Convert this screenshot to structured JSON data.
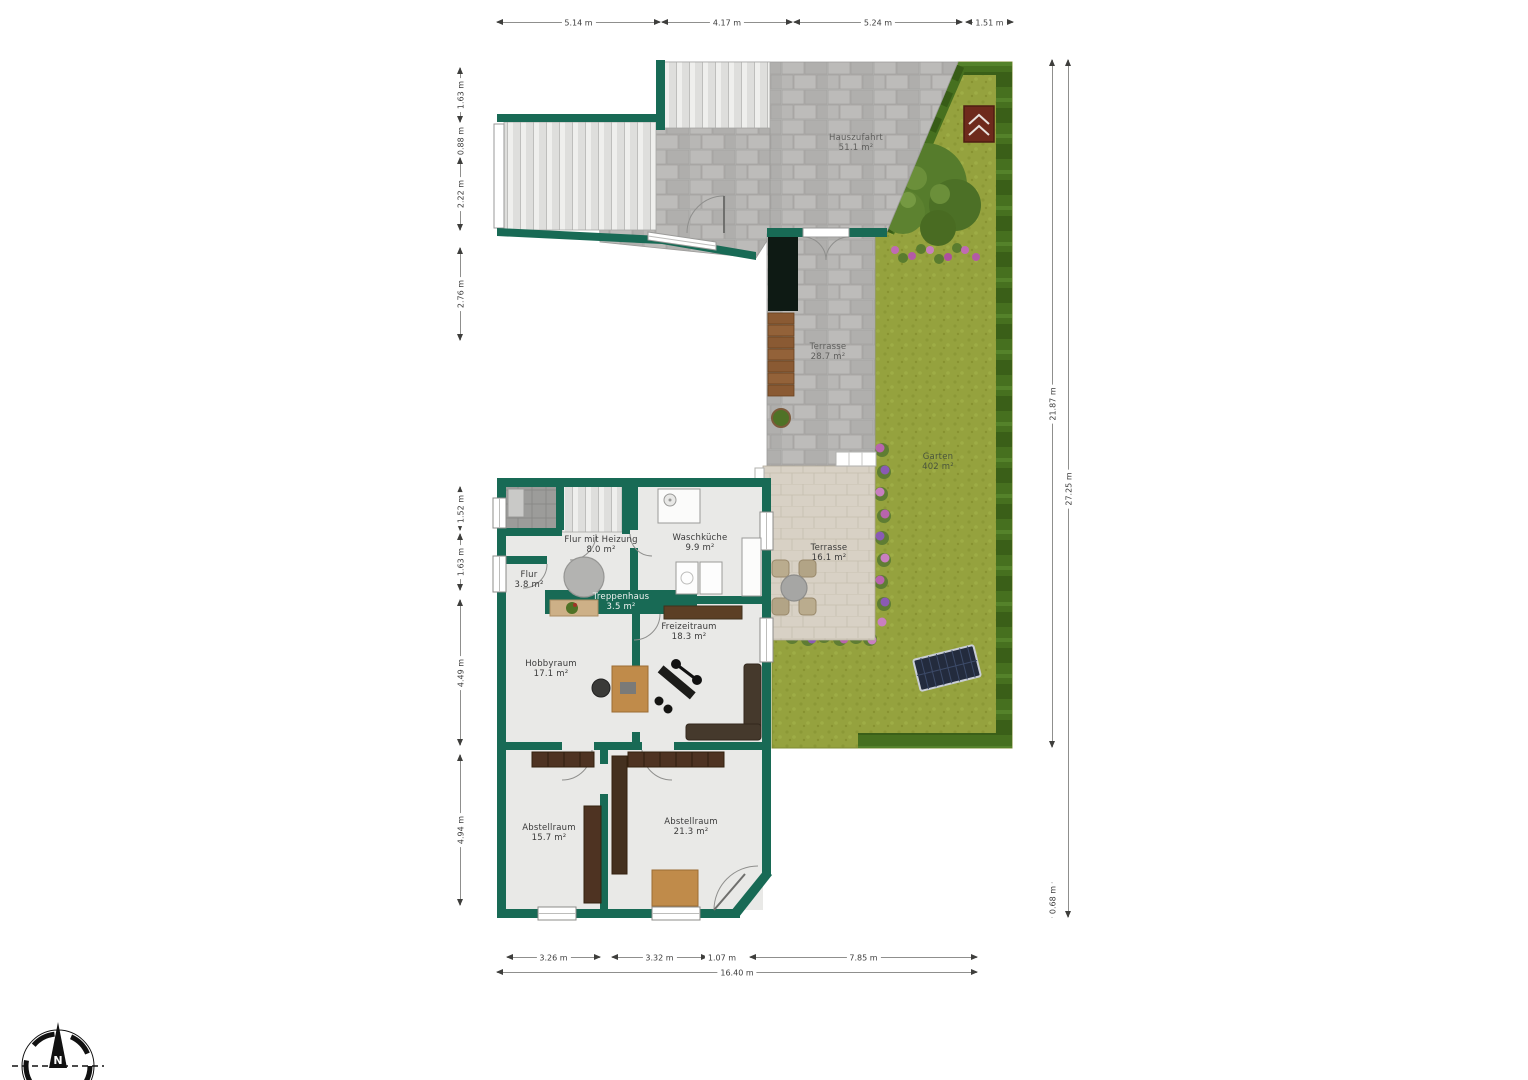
{
  "page": {
    "type": "floor-plan",
    "background": "#ffffff"
  },
  "colors": {
    "wall": "#186a55",
    "floor": "#e9e9e7",
    "paving": "#b6b5b3",
    "terrace": "#d8d1c5",
    "grass": "#95a23e",
    "hedge": "#46701f",
    "dimension_text": "#3c3c3c"
  },
  "compass": {
    "north_label": "N"
  },
  "room_labels": [
    {
      "name": "Flur mit Heizung",
      "area": "8.0 m²",
      "x": 601,
      "y": 545,
      "tone": "dark"
    },
    {
      "name": "Waschküche",
      "area": "9.9 m²",
      "x": 700,
      "y": 543,
      "tone": "dark"
    },
    {
      "name": "Flur",
      "area": "3.8 m²",
      "x": 529,
      "y": 580,
      "tone": "dark"
    },
    {
      "name": "Treppenhaus",
      "area": "3.5 m²",
      "x": 621,
      "y": 602,
      "tone": "light"
    },
    {
      "name": "Freizeitraum",
      "area": "18.3 m²",
      "x": 689,
      "y": 632,
      "tone": "dark"
    },
    {
      "name": "Hobbyraum",
      "area": "17.1 m²",
      "x": 551,
      "y": 669,
      "tone": "dark"
    },
    {
      "name": "Abstellraum",
      "area": "15.7 m²",
      "x": 549,
      "y": 833,
      "tone": "dark"
    },
    {
      "name": "Abstellraum",
      "area": "21.3 m²",
      "x": 691,
      "y": 827,
      "tone": "dark"
    },
    {
      "name": "Terrasse",
      "area": "16.1 m²",
      "x": 829,
      "y": 553,
      "tone": "dark"
    },
    {
      "name": "Terrasse",
      "area": "28.7 m²",
      "x": 828,
      "y": 352,
      "tone": "paving"
    },
    {
      "name": "Hauszufahrt",
      "area": "51.1 m²",
      "x": 856,
      "y": 143,
      "tone": "paving"
    },
    {
      "name": "Garten",
      "area": "402 m²",
      "x": 938,
      "y": 462,
      "tone": "grass"
    }
  ],
  "dimensions": [
    {
      "label": "5.14 m",
      "o": "h",
      "x": 497,
      "y": 22,
      "len": 163
    },
    {
      "label": "4.17 m",
      "o": "h",
      "x": 662,
      "y": 22,
      "len": 130
    },
    {
      "label": "5.24 m",
      "o": "h",
      "x": 794,
      "y": 22,
      "len": 168
    },
    {
      "label": "1.51 m",
      "o": "h",
      "x": 966,
      "y": 22,
      "len": 47
    },
    {
      "label": "1.63 m",
      "o": "v",
      "x": 460,
      "y": 68,
      "len": 54
    },
    {
      "label": "0.88 m",
      "o": "v",
      "x": 460,
      "y": 126,
      "len": 29
    },
    {
      "label": "2.22 m",
      "o": "v",
      "x": 460,
      "y": 158,
      "len": 72
    },
    {
      "label": "2.76 m",
      "o": "v",
      "x": 460,
      "y": 248,
      "len": 92
    },
    {
      "label": "1.52 m",
      "o": "v",
      "x": 460,
      "y": 487,
      "len": 43
    },
    {
      "label": "1.63 m",
      "o": "v",
      "x": 460,
      "y": 534,
      "len": 56
    },
    {
      "label": "4.49 m",
      "o": "v",
      "x": 460,
      "y": 600,
      "len": 145
    },
    {
      "label": "4.94 m",
      "o": "v",
      "x": 460,
      "y": 755,
      "len": 150
    },
    {
      "label": "21.87 m",
      "o": "v",
      "x": 1052,
      "y": 60,
      "len": 687
    },
    {
      "label": "27.25 m",
      "o": "v",
      "x": 1068,
      "y": 60,
      "len": 857
    },
    {
      "label": "0.68 m",
      "o": "v",
      "x": 1052,
      "y": 883,
      "len": 34
    },
    {
      "label": "3.26 m",
      "o": "h",
      "x": 507,
      "y": 957,
      "len": 93
    },
    {
      "label": "3.32 m",
      "o": "h",
      "x": 612,
      "y": 957,
      "len": 95
    },
    {
      "label": "1.07 m",
      "o": "h",
      "x": 707,
      "y": 957,
      "len": 30
    },
    {
      "label": "7.85 m",
      "o": "h",
      "x": 750,
      "y": 957,
      "len": 227
    },
    {
      "label": "16.40 m",
      "o": "h",
      "x": 497,
      "y": 972,
      "len": 480
    }
  ]
}
